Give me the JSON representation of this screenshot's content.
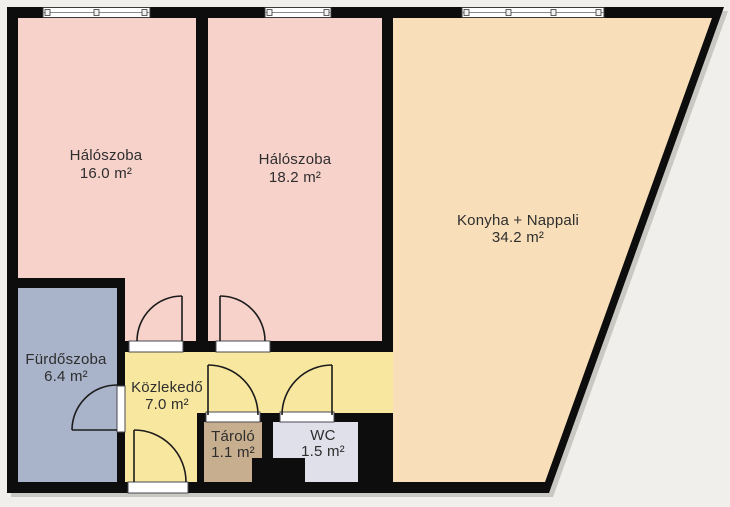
{
  "plan": {
    "title": "Lakás alaprajz",
    "rooms": [
      {
        "id": "haloszoba-1",
        "name": "Hálószoba",
        "area": "16.0 m²",
        "color": "#f7d2cb"
      },
      {
        "id": "haloszoba-2",
        "name": "Hálószoba",
        "area": "18.2 m²",
        "color": "#f7d2cb"
      },
      {
        "id": "konyha-nappali",
        "name": "Konyha + Nappali",
        "area": "34.2 m²",
        "color": "#f8dfb9"
      },
      {
        "id": "furdoszoba",
        "name": "Fürdőszoba",
        "area": "6.4 m²",
        "color": "#a9b3c9"
      },
      {
        "id": "kozlekedo",
        "name": "Közlekedő",
        "area": "7.0 m²",
        "color": "#f8e79e"
      },
      {
        "id": "tarolo",
        "name": "Tároló",
        "area": "1.1 m²",
        "color": "#c6ae8f"
      },
      {
        "id": "wc",
        "name": "WC",
        "area": "1.5 m²",
        "color": "#e0e0ea"
      }
    ],
    "colors": {
      "background": "#f0efec",
      "wall": "#0d0d0d",
      "shadow": "#c9c8c2",
      "window_frame": "#ffffff",
      "threshold": "#ffffff",
      "door_stroke": "#1c1c1c",
      "label_text": "#2e2e2e"
    },
    "counts": {
      "windows": "3",
      "doors": "6"
    }
  }
}
